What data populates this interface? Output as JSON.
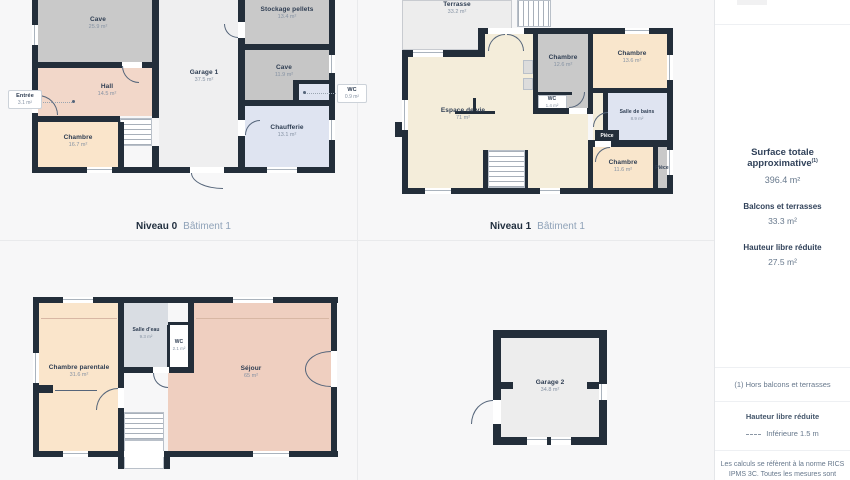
{
  "plans": [
    {
      "name": "Niveau 0",
      "building": "Bâtiment 1",
      "rooms": [
        {
          "name": "Cave",
          "area": "25.9 m²"
        },
        {
          "name": "Stockage pellets",
          "area": "13.4 m²"
        },
        {
          "name": "Cave",
          "area": "11.9 m²"
        },
        {
          "name": "Garage 1",
          "area": "37.5 m²"
        },
        {
          "name": "Hall",
          "area": "14.5 m²"
        },
        {
          "name": "Chambre",
          "area": "16.7 m²"
        },
        {
          "name": "Chaufferie",
          "area": "13.1 m²"
        }
      ],
      "badges": [
        {
          "name": "Entrée",
          "area": "3.1 m²"
        },
        {
          "name": "WC",
          "area": "0.9 m²"
        }
      ]
    },
    {
      "name": "Niveau 1",
      "building": "Bâtiment 1",
      "rooms": [
        {
          "name": "Terrasse",
          "area": "33.2 m²"
        },
        {
          "name": "Chambre",
          "area": "12.6 m²"
        },
        {
          "name": "Chambre",
          "area": "13.6 m²"
        },
        {
          "name": "Espace de vie",
          "area": "71 m²"
        },
        {
          "name": "WC",
          "area": "1.4 m²"
        },
        {
          "name": "Salle de bains",
          "area": "8.9 m²"
        },
        {
          "name": "Pièce"
        },
        {
          "name": "Chambre",
          "area": "11.6 m²"
        },
        {
          "name": "Pièce"
        }
      ]
    },
    {
      "rooms": [
        {
          "name": "Chambre parentale",
          "area": "31.6 m²"
        },
        {
          "name": "Salle d'eau",
          "area": "9.3 m²"
        },
        {
          "name": "WC",
          "area": "2.1 m²"
        },
        {
          "name": "Séjour",
          "area": "65 m²"
        }
      ]
    },
    {
      "rooms": [
        {
          "name": "Garage 2",
          "area": "34.8 m²"
        }
      ]
    }
  ],
  "sidebar": {
    "title": "Surface totale approximative",
    "title_sup": "(1)",
    "total": "396.4 m²",
    "balconies_label": "Balcons et terrasses",
    "balconies_value": "33.3 m²",
    "height_label": "Hauteur libre réduite",
    "height_value": "27.5 m²",
    "footnote": "(1) Hors balcons et terrasses",
    "legend_title": "Hauteur libre réduite",
    "legend_item": "Inférieure 1.5 m",
    "disclaimer_line1": "Les calculs se réfèrent à la norme RICS",
    "disclaimer_line2": "IPMS 3C. Toutes les mesures sont"
  },
  "colors": {
    "wall": "#232e3a",
    "background": "#f7f7f8",
    "room_gray": "#c9c9c9",
    "room_lightgray": "#ededed",
    "room_cream": "#f4edda",
    "room_peach": "#fae5cb",
    "room_pink": "#f2d7c9",
    "room_salmon": "#efcfc0",
    "room_blue": "#dfe4f1"
  }
}
